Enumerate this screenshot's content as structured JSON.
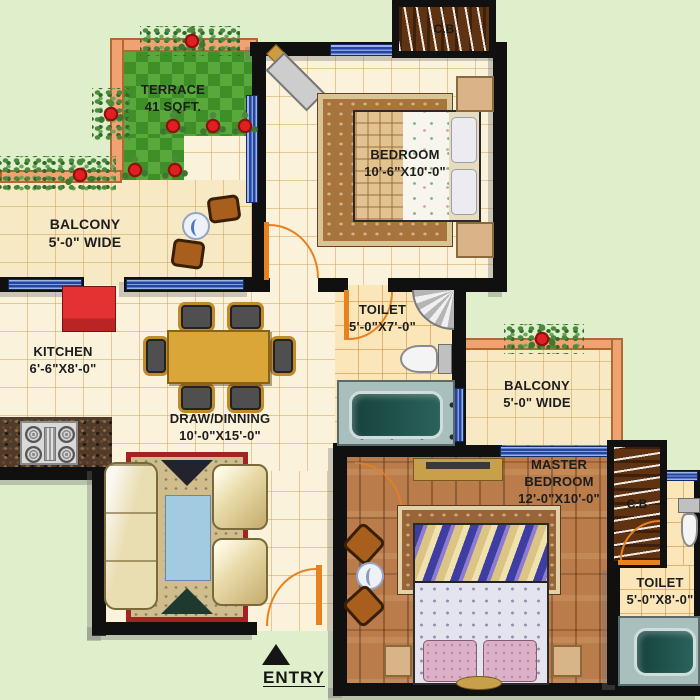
{
  "plan": {
    "entry_label": "ENTRY",
    "rooms": {
      "terrace": {
        "name": "TERRACE",
        "dims": "41 SQFT."
      },
      "balcony_left": {
        "name": "BALCONY",
        "dims": "5'-0\" WIDE"
      },
      "bedroom": {
        "name": "BEDROOM",
        "dims": "10'-6\"X10'-0\""
      },
      "toilet_top": {
        "name": "TOILET",
        "dims": "5'-0\"X7'-0\""
      },
      "kitchen": {
        "name": "KITCHEN",
        "dims": "6'-6\"X8'-0\""
      },
      "draw_dining": {
        "name": "DRAW/DINNING",
        "dims": "10'-0\"X15'-0\""
      },
      "balcony_right": {
        "name": "BALCONY",
        "dims": "5'-0\" WIDE"
      },
      "master_bedroom": {
        "name_line1": "MASTER",
        "name_line2": "BEDROOM",
        "dims": "12'-0\"X10'-0\""
      },
      "toilet_right": {
        "name": "TOILET",
        "dims": "5'-0\"X8'-0\""
      }
    },
    "cupboards": {
      "top": "C.B",
      "right": "C.B"
    },
    "colors": {
      "outside_green": "#dfeecb",
      "wall_black": "#101010",
      "balcony_wall_orange": "#f0a272",
      "window_blue": "#24459e",
      "grass_green": "#58a83c",
      "floor_cream": "#faf2da",
      "toilet_floor_gold": "#fae6b8",
      "wood_brown": "#b97c4a",
      "door_arc_orange": "#e8821e",
      "rug_red": "#a32222"
    }
  }
}
